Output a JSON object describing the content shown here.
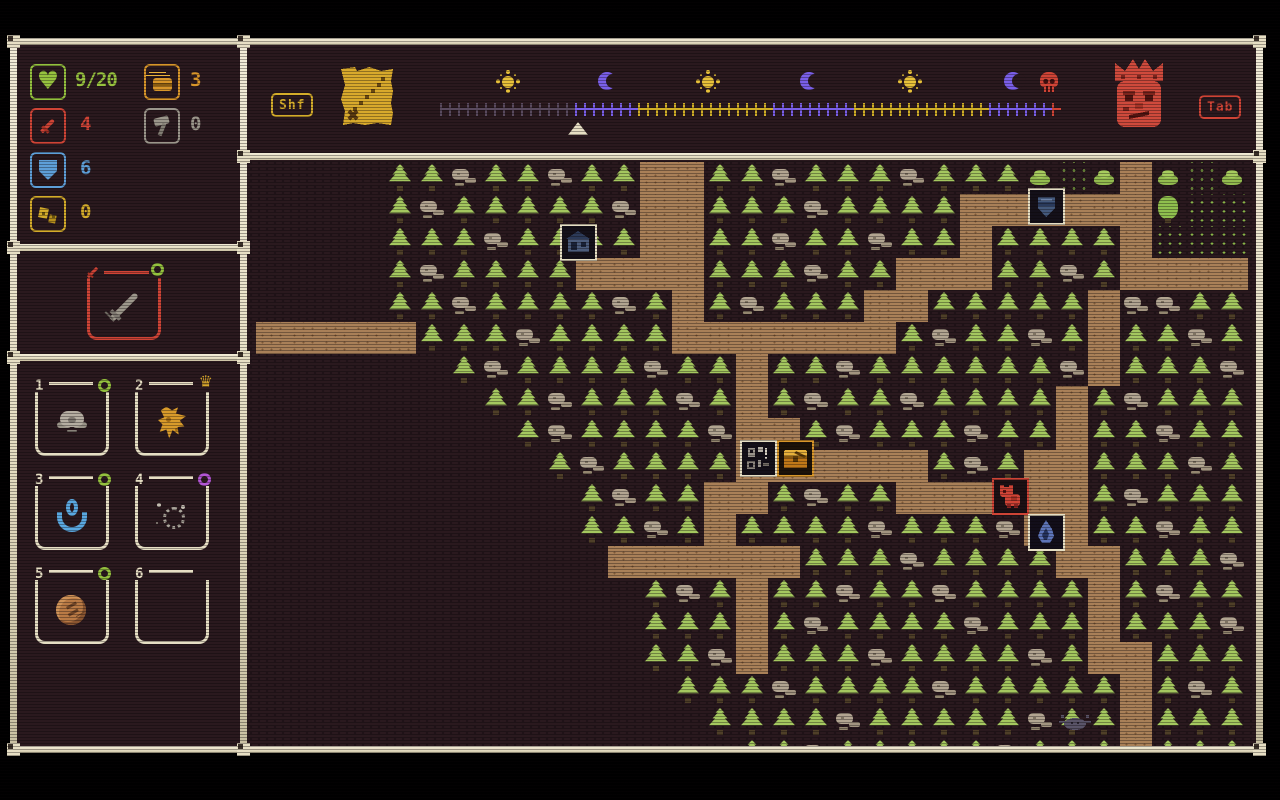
{
  "colors": {
    "cream": "#e7dfc4",
    "panel_bg": "#2a191e",
    "red": "#cf4436",
    "green": "#94c13e",
    "heart_green": "#97c23f",
    "blue": "#5e9fd8",
    "orange": "#d8962a",
    "gold": "#d4ac2a",
    "grey": "#9b968b",
    "purple_badge": "#b255d4",
    "timeline": {
      "past": "#594a5e",
      "night": "#7a5fe8",
      "day": "#cfae27",
      "boss": "#cf4436"
    }
  },
  "hud": {
    "stats": [
      {
        "name": "health",
        "icon": "heart-icon",
        "value": "9/20",
        "color": "#97c23f"
      },
      {
        "name": "gold",
        "icon": "gold-icon",
        "value": "3",
        "color": "#d8962a"
      },
      {
        "name": "attack",
        "icon": "sword-icon",
        "value": "4",
        "color": "#cf4436"
      },
      {
        "name": "hammers",
        "icon": "hammer-icon",
        "value": "0",
        "color": "#9b968b"
      },
      {
        "name": "defense",
        "icon": "shield-icon",
        "value": "6",
        "color": "#5e9fd8"
      },
      {
        "name": "scrap",
        "icon": "scrap-icon",
        "value": "0",
        "color": "#d4ac2a"
      }
    ],
    "equipment": {
      "item": "iron-sword",
      "corner_icon": "sword-icon",
      "badge": "green-ring"
    },
    "inventory": [
      {
        "number": "1",
        "badge": "green-ring",
        "item": "grey-ore"
      },
      {
        "number": "2",
        "badge": "gold-crown",
        "item": "gold-relic"
      },
      {
        "number": "3",
        "badge": "green-ring",
        "item": "blue-amulet"
      },
      {
        "number": "4",
        "badge": "purple-ring",
        "item": "grey-dust"
      },
      {
        "number": "5",
        "badge": "green-ring",
        "item": "bronze-coin"
      },
      {
        "number": "6",
        "badge": null,
        "item": null
      }
    ]
  },
  "topbar": {
    "shift_key_label": "Shf",
    "tab_key_label": "Tab",
    "map_button": "treasure-map-icon",
    "boss_button": "dwarf-king-icon",
    "timeline": {
      "icons": [
        {
          "type": "sun",
          "x": 56
        },
        {
          "type": "moon",
          "x": 156
        },
        {
          "type": "sun",
          "x": 256
        },
        {
          "type": "moon",
          "x": 358
        },
        {
          "type": "sun",
          "x": 458
        },
        {
          "type": "moon",
          "x": 562
        },
        {
          "type": "skull",
          "x": 598
        }
      ],
      "segments": [
        {
          "phase": "past",
          "ticks": 15
        },
        {
          "phase": "night",
          "ticks": 7
        },
        {
          "phase": "day",
          "ticks": 15
        },
        {
          "phase": "night",
          "ticks": 9
        },
        {
          "phase": "day",
          "ticks": 15
        },
        {
          "phase": "night",
          "ticks": 7
        },
        {
          "phase": "boss",
          "ticks": 1
        }
      ],
      "marker_x": 128
    }
  },
  "map": {
    "tile_size": 32,
    "legend": {
      ".": "unexplored",
      "t": "pine",
      "r": "rocks",
      "p": "path",
      "b": "bush",
      "g": "grass",
      "o": "tree"
    },
    "tiles": [
      "....ttrttrttppttrtttrtttbgbpbgb",
      "....trtttttrpptttrttttppppppogg",
      "....tttrttttppttrttrttpttttpggg",
      "....trttttpppptttrttpppttrtpppp",
      "....ttrttttrtptrtttpptttttprrtt",
      "ppppptttrttttppppppptrttrtpttrt",
      "......trttttrttpttrttttttrptttr",
      ".......ttrtttrtptrttrttttptrttt",
      "........trttttrpptrtttrttpttrtt",
      ".........trttttpppppptrtpptttrt",
      "..........trttpptrttpppppptrttt",
      "..........ttrtpttttrtttrppttrtt",
      "...........pppppptttrttttpptttr",
      "............trtpttrttrttttptrtt",
      "............tttptrttttrtttptttr",
      "............ttrptttrttttrtppttt",
      ".............tttrttttrtttttptrt",
      "..............ttttrtttttrttpttt",
      "...............ttrtttttrtttpttt"
    ],
    "markers": [
      {
        "name": "cabin",
        "x": 313,
        "y": 64,
        "border": "#e7dfc4"
      },
      {
        "name": "shield-shop",
        "x": 781,
        "y": 28,
        "border": "#e7dfc4"
      },
      {
        "name": "runes",
        "x": 493,
        "y": 280,
        "border": "#e7dfc4"
      },
      {
        "name": "chest",
        "x": 530,
        "y": 280,
        "border": "#d8962a"
      },
      {
        "name": "bear",
        "x": 745,
        "y": 318,
        "border": "#cf4436"
      },
      {
        "name": "flame",
        "x": 781,
        "y": 354,
        "border": "#e7dfc4"
      },
      {
        "name": "spider",
        "x": 806,
        "y": 552,
        "border": null
      }
    ]
  }
}
